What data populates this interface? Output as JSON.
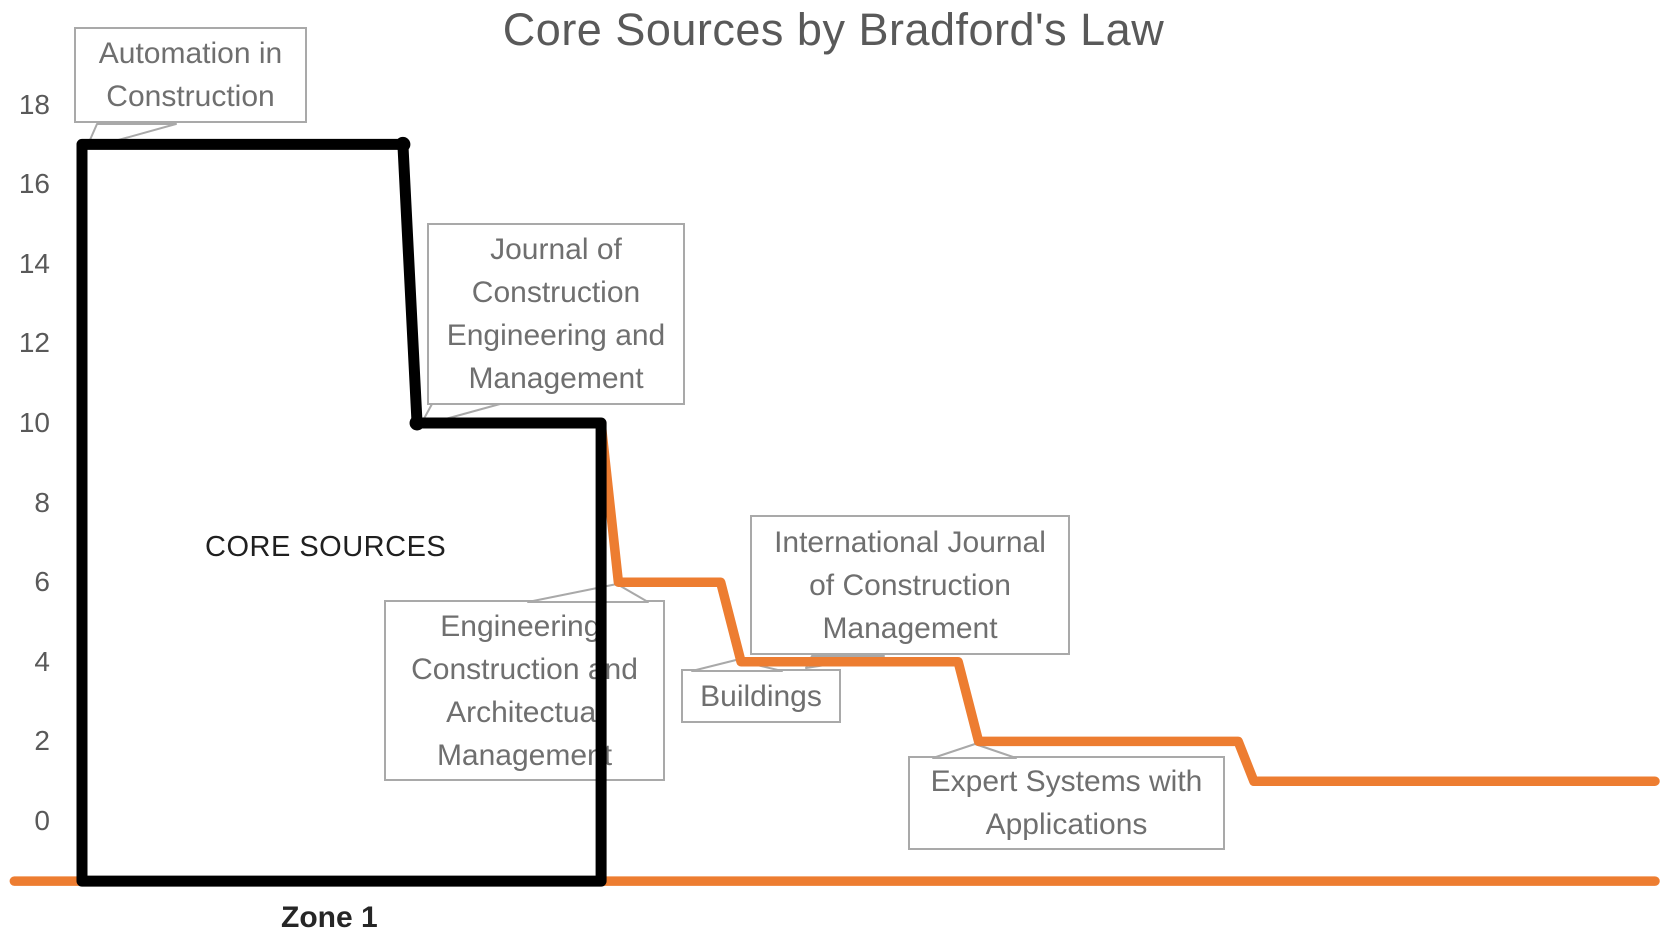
{
  "chart_data": {
    "type": "line",
    "title": "Core Sources by Bradford's Law",
    "x_axis": {
      "label": "",
      "tick_labels": [],
      "zone_label": "Zone 1",
      "meaning": "sources ranked by number of articles"
    },
    "y_axis": {
      "ticks": [
        18,
        16,
        14,
        12,
        10,
        8,
        6,
        4,
        2,
        0
      ],
      "range_shown": [
        0,
        18
      ],
      "gridlines": false
    },
    "x_unit": "percent-of-plot-width",
    "y_unit": "articles",
    "series": [
      {
        "name": "articles-per-source",
        "color": "#ED7D31",
        "stroke_width": 9.5,
        "points": [
          [
            0,
            17
          ],
          [
            20.4,
            17
          ],
          [
            21.3,
            10
          ],
          [
            33,
            10
          ],
          [
            34.1,
            6
          ],
          [
            40.6,
            6
          ],
          [
            41.9,
            4
          ],
          [
            55.7,
            4
          ],
          [
            57,
            2
          ],
          [
            73.5,
            2
          ],
          [
            74.5,
            1
          ],
          [
            100,
            1
          ]
        ]
      },
      {
        "name": "axis-baseline",
        "color": "#ED7D31",
        "stroke_width": 9.5,
        "points": [
          [
            -4.3,
            -1.51
          ],
          [
            100,
            -1.51
          ]
        ]
      }
    ],
    "markers": {
      "color": "#000000",
      "radius": 7.5,
      "points": [
        [
          20.4,
          17
        ],
        [
          21.3,
          10
        ]
      ]
    },
    "core_zone": {
      "label": "CORE SOURCES",
      "zone_label": "Zone 1",
      "outline_color": "#000000",
      "stroke_width": 11,
      "outline_points": [
        [
          0,
          -1.51
        ],
        [
          0,
          17
        ],
        [
          20.4,
          17
        ],
        [
          21.3,
          10
        ],
        [
          33,
          10
        ],
        [
          33,
          -1.51
        ]
      ]
    },
    "annotations": [
      {
        "source": "Automation in Construction",
        "articles": 17
      },
      {
        "source": "Journal of Construction Engineering and Management",
        "articles": 10
      },
      {
        "source": "Engineering, Construction and Architectual Management",
        "articles": 6
      },
      {
        "source": "Buildings",
        "articles": 4
      },
      {
        "source": "International Journal of Construction Management",
        "articles": 4
      },
      {
        "source": "Expert Systems with Applications",
        "articles": 2
      }
    ]
  },
  "labels": {
    "core_sources": "CORE SOURCES",
    "zone1": "Zone 1"
  },
  "colors": {
    "orange_line": "#ED7D31",
    "zone_outline": "#000000",
    "callout_border": "#A9A9A9",
    "callout_text": "#6F6F6F",
    "axis_text": "#595959",
    "title_text": "#595959"
  }
}
